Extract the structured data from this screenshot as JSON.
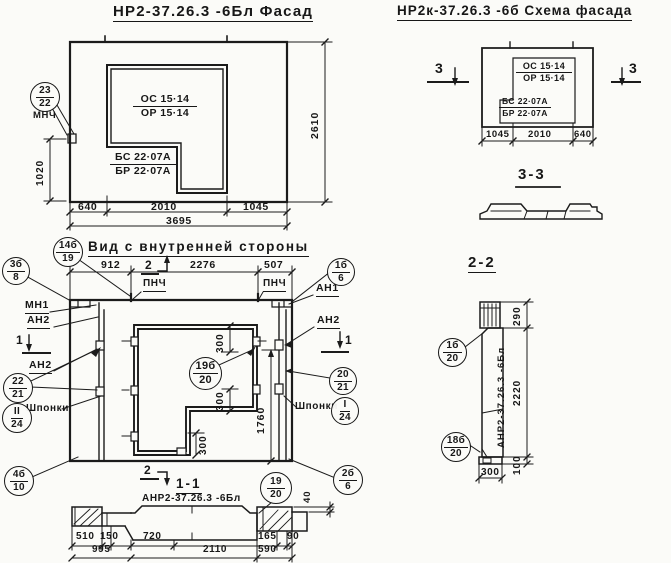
{
  "facade": {
    "title": "НР2-37.26.3 -6Бл Фасад",
    "win_top": "ОС 15·14",
    "win_bot": "ОР 15·14",
    "blk_top": "БС 22·07А",
    "blk_bot": "БР 22·07А",
    "callout": {
      "top": "23",
      "bottom": "22"
    },
    "callout_label": "МНЧ",
    "dim_left": "1020",
    "dim_right": "2610",
    "dim_640": "640",
    "dim_2010": "2010",
    "dim_1045": "1045",
    "dim_total": "3695"
  },
  "scheme": {
    "title": "НР2к-37.26.3 -6б Схема фасада",
    "win_top": "ОС 15·14",
    "win_bot": "ОР 15·14",
    "blk_top": "БС 22·07А",
    "blk_bot": "БР 22·07А",
    "marker": "3",
    "dim_1045": "1045",
    "dim_2010": "2010",
    "dim_640": "640",
    "section_title": "3-3"
  },
  "inner": {
    "title": "Вид с внутренней стороны",
    "dim_912": "912",
    "dim_2276": "2276",
    "dim_507": "507",
    "dim_300": "300",
    "dim_1760": "1760",
    "label_pnch": "ПНЧ",
    "label_mn1": "МН1",
    "label_an1": "АН1",
    "label_an2": "АН2",
    "label_shponki": "Шпонки",
    "marker_1": "1",
    "marker_2": "2",
    "callouts": {
      "c14b19": {
        "top": "14б",
        "bottom": "19"
      },
      "c3b8": {
        "top": "3б",
        "bottom": "8"
      },
      "c1b6": {
        "top": "1б",
        "bottom": "6"
      },
      "c22_21": {
        "top": "22",
        "bottom": "21"
      },
      "c20_21": {
        "top": "20",
        "bottom": "21"
      },
      "cII24": {
        "top": "II",
        "bottom": "24"
      },
      "cI24": {
        "top": "I",
        "bottom": "24"
      },
      "c4b10": {
        "top": "4б",
        "bottom": "10"
      },
      "c2b6": {
        "top": "2б",
        "bottom": "6"
      },
      "c19b20": {
        "top": "19б",
        "bottom": "20"
      }
    }
  },
  "section11": {
    "title": "1-1",
    "label": "АНР2-37.26.3 -6Бл",
    "dim_510": "510",
    "dim_150": "150",
    "dim_720": "720",
    "dim_165": "165",
    "dim_90": "90",
    "dim_995": "995",
    "dim_2110": "2110",
    "dim_590": "590",
    "dim_40": "40",
    "callout": {
      "top": "19",
      "bottom": "20"
    }
  },
  "section22": {
    "title": "2-2",
    "label": "АНР2-37.26.3 -6Бл",
    "dim_290": "290",
    "dim_2220": "2220",
    "dim_100": "100",
    "dim_300": "300",
    "callouts": {
      "c1b20": {
        "top": "1б",
        "bottom": "20"
      },
      "c18b20": {
        "top": "18б",
        "bottom": "20"
      }
    }
  }
}
